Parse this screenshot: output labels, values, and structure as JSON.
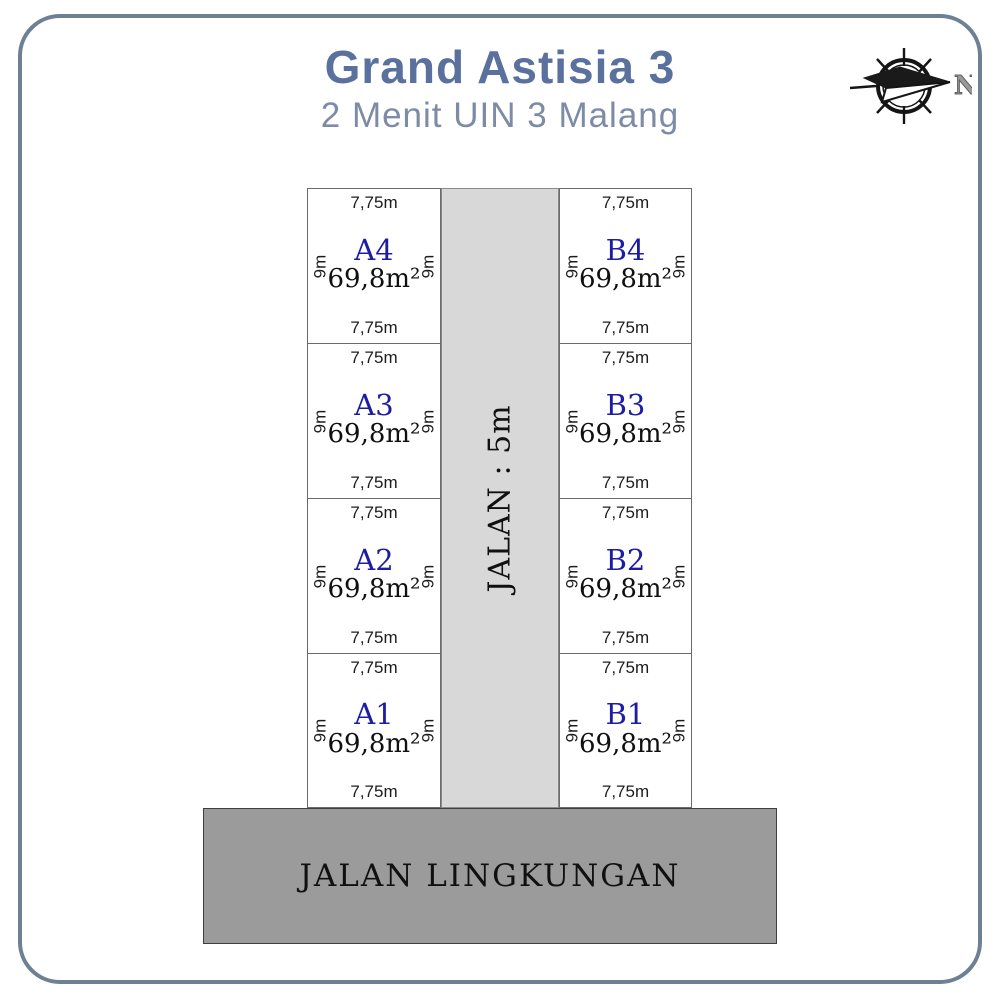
{
  "header": {
    "title": "Grand Astisia 3",
    "subtitle": "2 Menit UIN 3 Malang"
  },
  "compass": {
    "north_label": "N"
  },
  "site": {
    "road_vertical_label": "JALAN : 5m",
    "road_bottom_label": "JALAN LINGKUNGAN",
    "plots": [
      {
        "id": "A4",
        "area": "69,8m²",
        "width_top": "7,75m",
        "width_bottom": "7,75m",
        "depth_left": "9m",
        "depth_right": "9m"
      },
      {
        "id": "A3",
        "area": "69,8m²",
        "width_top": "7,75m",
        "width_bottom": "7,75m",
        "depth_left": "9m",
        "depth_right": "9m"
      },
      {
        "id": "A2",
        "area": "69,8m²",
        "width_top": "7,75m",
        "width_bottom": "7,75m",
        "depth_left": "9m",
        "depth_right": "9m"
      },
      {
        "id": "A1",
        "area": "69,8m²",
        "width_top": "7,75m",
        "width_bottom": "7,75m",
        "depth_left": "9m",
        "depth_right": "9m"
      },
      {
        "id": "B4",
        "area": "69,8m²",
        "width_top": "7,75m",
        "width_bottom": "7,75m",
        "depth_left": "9m",
        "depth_right": "9m"
      },
      {
        "id": "B3",
        "area": "69,8m²",
        "width_top": "7,75m",
        "width_bottom": "7,75m",
        "depth_left": "9m",
        "depth_right": "9m"
      },
      {
        "id": "B2",
        "area": "69,8m²",
        "width_top": "7,75m",
        "width_bottom": "7,75m",
        "depth_left": "9m",
        "depth_right": "9m"
      },
      {
        "id": "B1",
        "area": "69,8m²",
        "width_top": "7,75m",
        "width_bottom": "7,75m",
        "depth_left": "9m",
        "depth_right": "9m"
      }
    ]
  },
  "colors": {
    "accent_title": "#5a709d",
    "accent_subtitle": "#7e8ba6",
    "plot_id_blue": "#1d1da3",
    "road_light_gray": "#d8d8d8",
    "road_dark_gray": "#9b9b9b",
    "card_border": "#6d8094"
  }
}
